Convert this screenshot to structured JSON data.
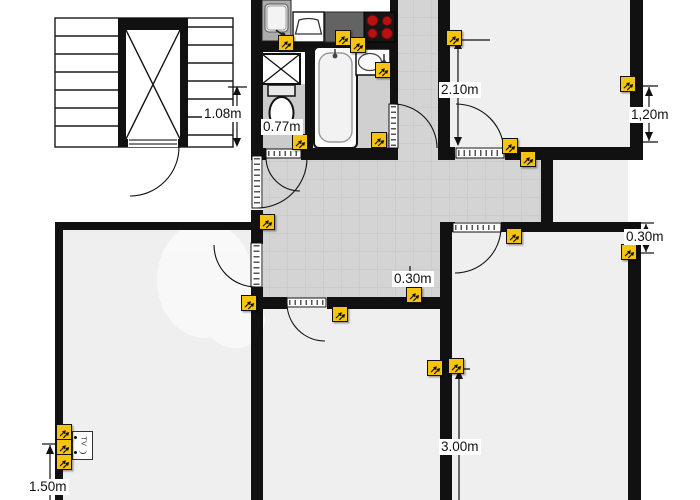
{
  "title": "apartment-floor-plan",
  "colors": {
    "wall": "#111111",
    "corridor_tile": "#d4d4d4",
    "tile_grid_line": "#c3c3c3",
    "room_floor": "#efefef",
    "bath_floor": "#d0d0d0",
    "marker_bg": "#f6c40e",
    "marker_border": "#111111",
    "stove_burner": "#b81111"
  },
  "icons": {
    "socket_marker": "double-power-socket-icon",
    "tv_socket": "tv-antenna-socket-icon",
    "elevator": "elevator-x-icon",
    "shaft": "crossed-shaft-icon"
  },
  "dimensions": {
    "stair_landing": {
      "label": "1.08m"
    },
    "wc_width": {
      "label": "0.77m"
    },
    "top_right_room": {
      "label": "2.10m"
    },
    "top_right_room_side": {
      "label": "1,20m"
    },
    "corridor_offset": {
      "label": "0.30m"
    },
    "right_room_offset": {
      "label": "0.30m"
    },
    "bottom_right_wall": {
      "label": "3.00m"
    },
    "bottom_left_wall": {
      "label": "1.50m"
    }
  },
  "fixtures": {
    "tv_socket_label": "TV"
  },
  "electrical": {
    "sockets": [
      {
        "x": 286,
        "y": 43
      },
      {
        "x": 343,
        "y": 38
      },
      {
        "x": 358,
        "y": 45
      },
      {
        "x": 383,
        "y": 70
      },
      {
        "x": 454,
        "y": 38
      },
      {
        "x": 628,
        "y": 84
      },
      {
        "x": 510,
        "y": 146
      },
      {
        "x": 528,
        "y": 159
      },
      {
        "x": 300,
        "y": 142
      },
      {
        "x": 379,
        "y": 140
      },
      {
        "x": 267,
        "y": 222
      },
      {
        "x": 249,
        "y": 303
      },
      {
        "x": 340,
        "y": 314
      },
      {
        "x": 414,
        "y": 295
      },
      {
        "x": 435,
        "y": 368
      },
      {
        "x": 456,
        "y": 366
      },
      {
        "x": 514,
        "y": 236
      },
      {
        "x": 629,
        "y": 252
      },
      {
        "x": 64,
        "y": 432
      },
      {
        "x": 64,
        "y": 447
      },
      {
        "x": 64,
        "y": 462
      }
    ]
  }
}
